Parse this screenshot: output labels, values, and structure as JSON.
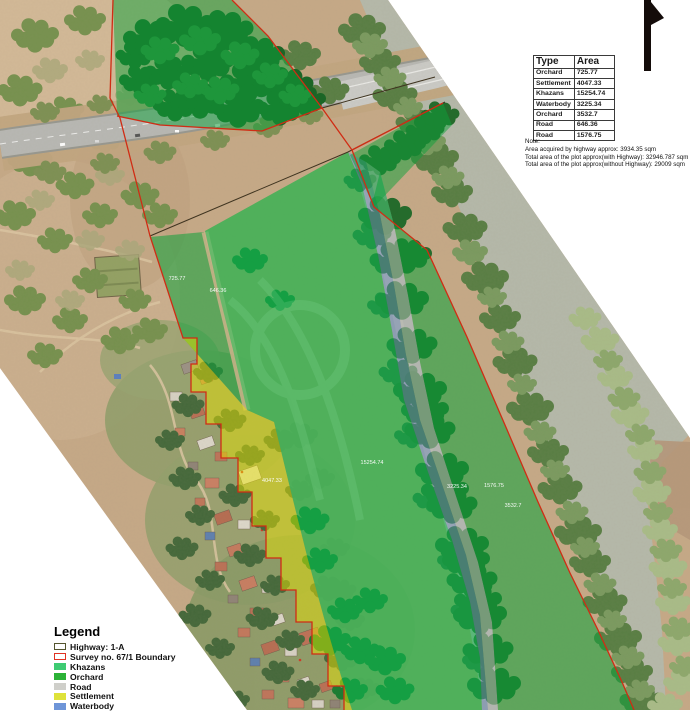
{
  "map": {
    "area_labels": [
      {
        "text": "725.77",
        "x": 177,
        "y": 280
      },
      {
        "text": "646.36",
        "x": 218,
        "y": 292
      },
      {
        "text": "4047.33",
        "x": 272,
        "y": 482
      },
      {
        "text": "15254.74",
        "x": 372,
        "y": 464
      },
      {
        "text": "3225.34",
        "x": 457,
        "y": 488
      },
      {
        "text": "1576.75",
        "x": 494,
        "y": 487
      },
      {
        "text": "3532.7",
        "x": 513,
        "y": 507
      }
    ]
  },
  "table": {
    "headers": [
      "Type",
      "Area"
    ],
    "rows": [
      [
        "Orchard",
        "725.77"
      ],
      [
        "Settlement",
        "4047.33"
      ],
      [
        "Khazans",
        "15254.74"
      ],
      [
        "Waterbody",
        "3225.34"
      ],
      [
        "Orchard",
        "3532.7"
      ],
      [
        "Road",
        "646.36"
      ],
      [
        "Road",
        "1576.75"
      ]
    ]
  },
  "note": {
    "title": "Note:",
    "lines": [
      "Area acquired by highway approx: 3934.35 sqm",
      "Total area of the plot approx(with Highway): 32946.787  sqm",
      "Total area of the plot approx(without Highway): 29009 sqm"
    ]
  },
  "legend": {
    "title": "Legend",
    "items": [
      {
        "name": "highway",
        "label": "Highway: 1-A",
        "fill": "#ffffff",
        "border": "#55552f"
      },
      {
        "name": "survey-boundary",
        "label": "Survey no. 67/1 Boundary",
        "fill": "#ffffff",
        "border": "#e03222"
      },
      {
        "name": "khazans",
        "label": "Khazans",
        "fill": "#3ecb72"
      },
      {
        "name": "orchard",
        "label": "Orchard",
        "fill": "#2cb237"
      },
      {
        "name": "road",
        "label": "Road",
        "fill": "#cfcfca"
      },
      {
        "name": "settlement",
        "label": "Settlement",
        "fill": "#dee23a"
      },
      {
        "name": "waterbody",
        "label": "Waterbody",
        "fill": "#6e95d8"
      }
    ]
  },
  "colors": {
    "boundary-red": "#d02c14",
    "khazans": "#0ec153",
    "orchard": "#0da23a",
    "settlement": "#e6df04",
    "waterbody": "#7b98d4",
    "road-overlay": "#c9c9c5",
    "map-label": "#ffffff"
  }
}
